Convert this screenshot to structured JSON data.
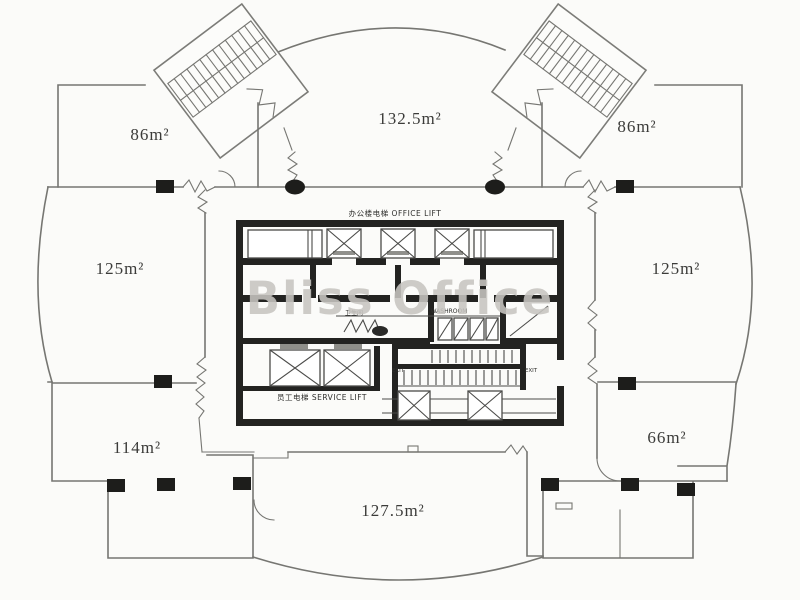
{
  "watermark": "Bliss Office",
  "rooms": {
    "top_left": "86m²",
    "top_center": "132.5m²",
    "top_right": "86m²",
    "mid_left": "125m²",
    "mid_right": "125m²",
    "bottom_left": "114m²",
    "bottom_right": "66m²",
    "bottom_center": "127.5m²"
  },
  "core": {
    "office_lift": "办公楼电梯 OFFICE LIFT",
    "service_lift": "员工电梯 SERVICE LIFT",
    "washroom_cn": "卫生间",
    "washroom_en": "WASHROOM",
    "exit": "EXIT"
  },
  "colors": {
    "background": "#fbfbf9",
    "outline": "#767672",
    "core_wall": "#232321",
    "column": "#1d1d1b",
    "label": "#3b3b39",
    "watermark": "#c7c5c1"
  }
}
